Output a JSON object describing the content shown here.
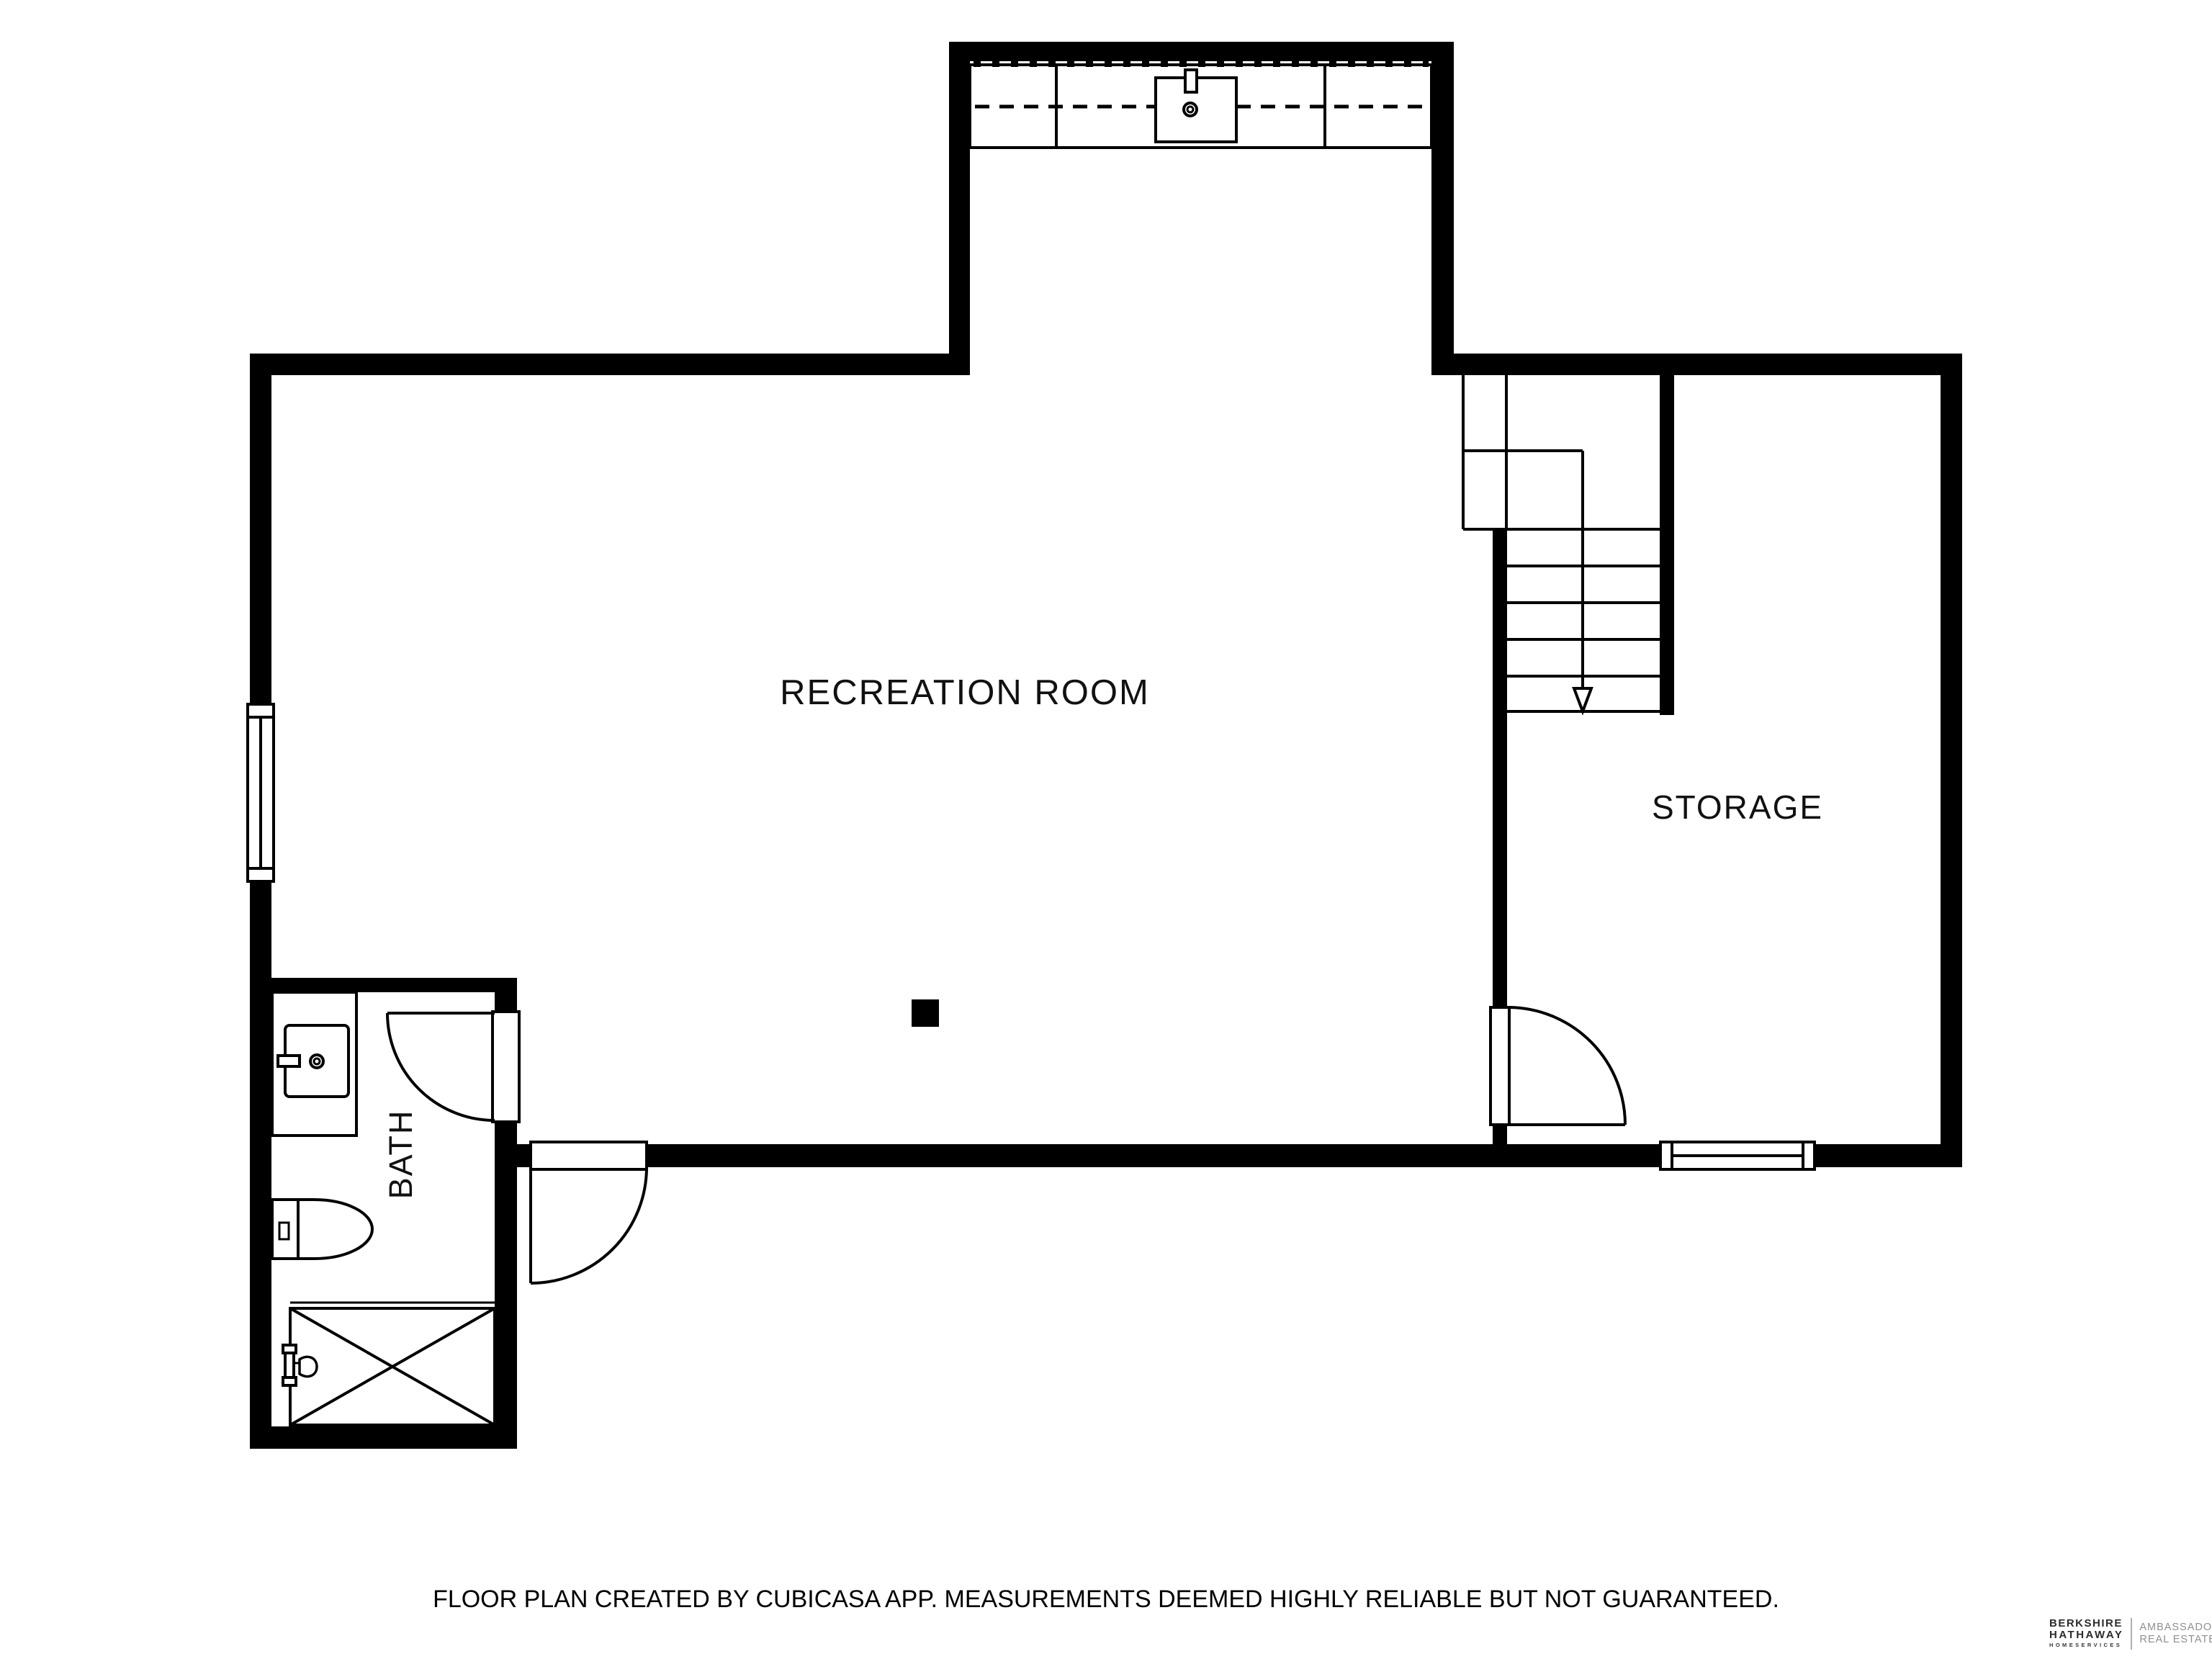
{
  "plan": {
    "rooms": [
      {
        "id": "recreation-room",
        "label": "RECREATION ROOM"
      },
      {
        "id": "storage",
        "label": "STORAGE"
      },
      {
        "id": "bath",
        "label": "BATH"
      }
    ],
    "stairs": {
      "direction": "down"
    },
    "fixtures": [
      "kitchen-counter",
      "kitchen-sink",
      "bathroom-vanity",
      "vanity-sink",
      "toilet",
      "shower",
      "support-post"
    ],
    "colors": {
      "walls": "#000000",
      "lines": "#000000",
      "floor": "#ffffff",
      "label_text": "#111111"
    }
  },
  "footer": {
    "disclaimer": "FLOOR PLAN CREATED BY CUBICASA APP. MEASUREMENTS DEEMED HIGHLY RELIABLE BUT NOT GUARANTEED."
  },
  "logo": {
    "brand_line1": "BERKSHIRE",
    "brand_line2": "HATHAWAY",
    "brand_line3": "HOMESERVICES",
    "division_line1": "AMBASSADOR",
    "division_line2": "REAL ESTATE",
    "brand_color": "#2e2a2b",
    "division_color": "#8f8f8f"
  }
}
